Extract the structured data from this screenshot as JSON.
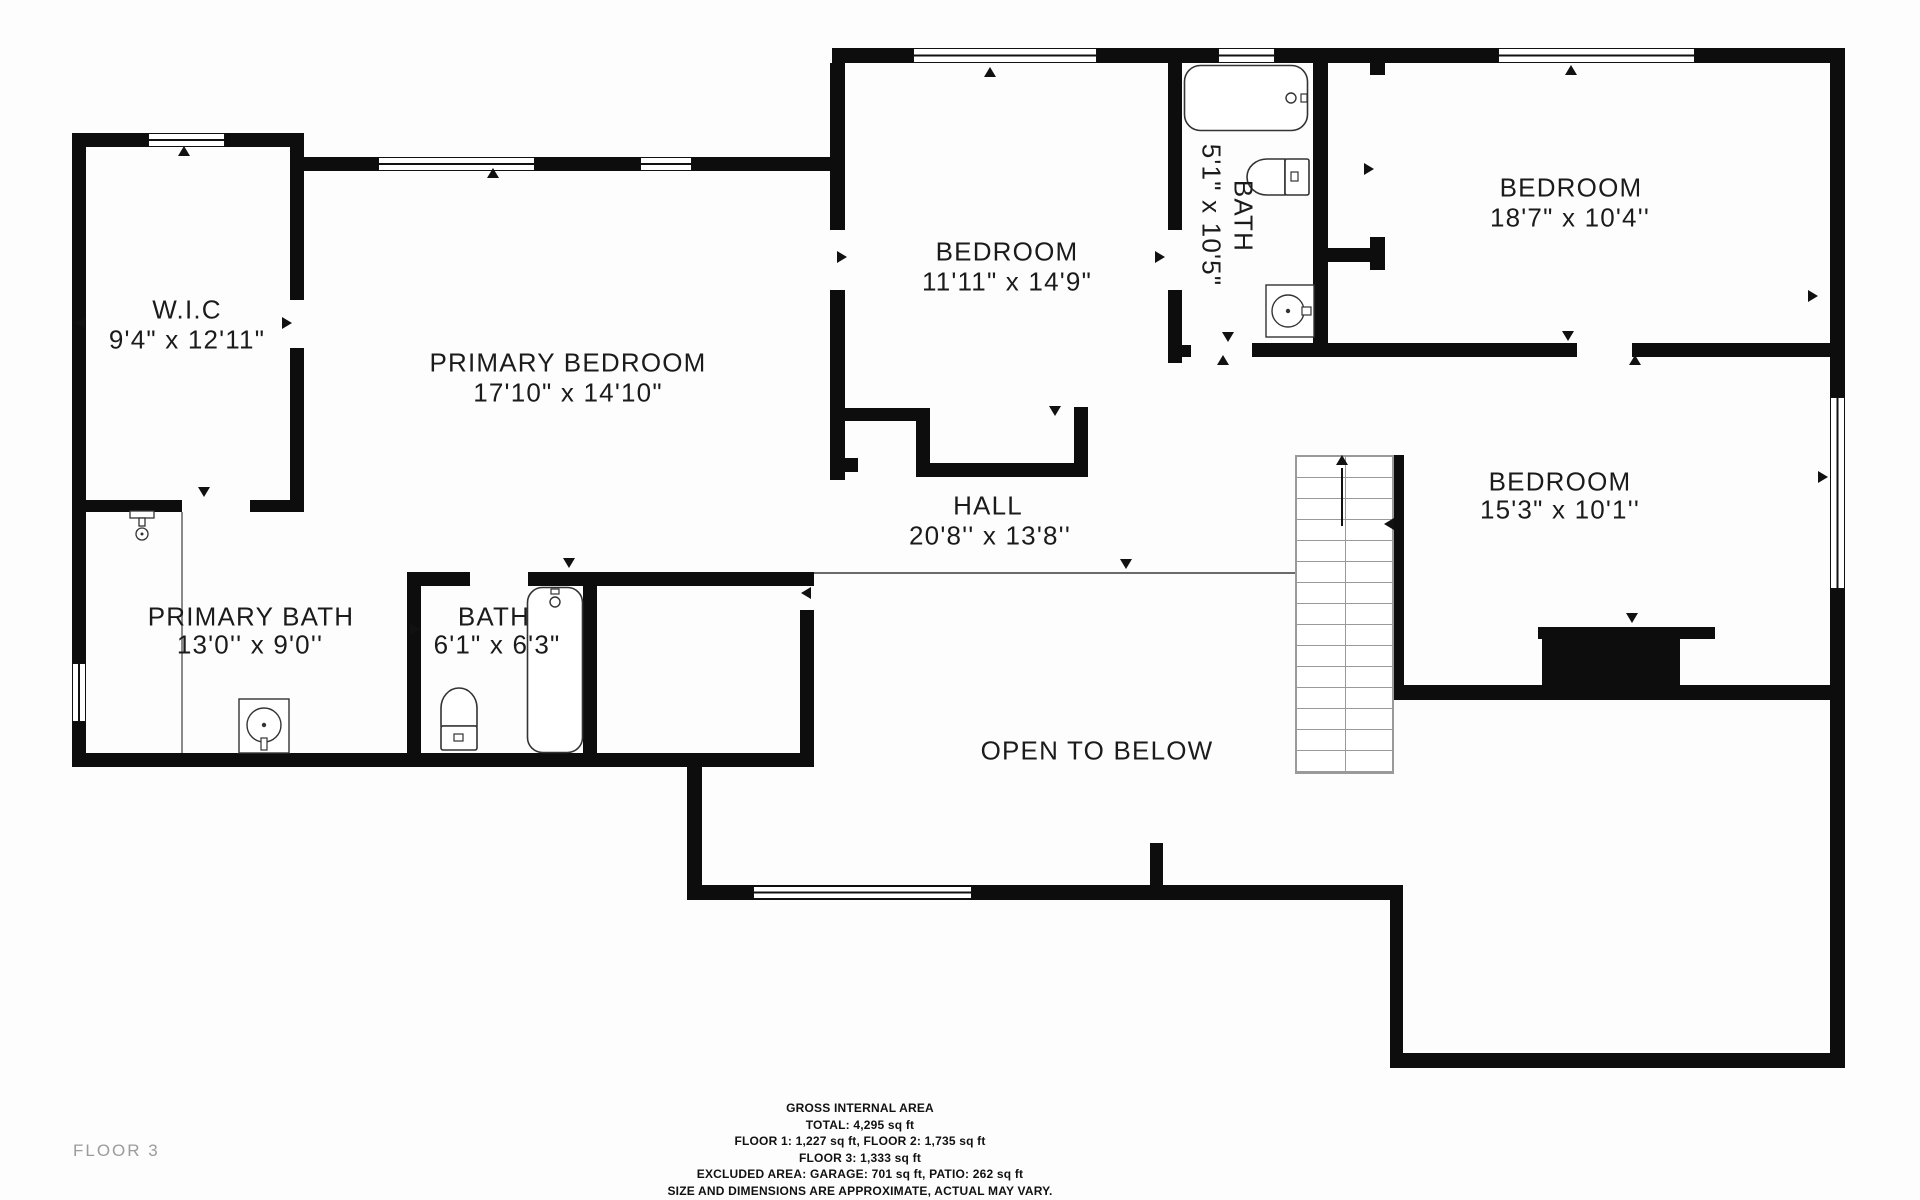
{
  "page": {
    "floor_label": "FLOOR 3",
    "background": "#fdfdfd"
  },
  "colors": {
    "wall": "#0d0d0d",
    "label": "#1b1b1b",
    "floor_label": "#9b9b9b",
    "stair_line": "#9a9a9a",
    "fixture_stroke": "#333333"
  },
  "rooms": [
    {
      "id": "wic",
      "name": "W.I.C",
      "dims": "9'4\" x 12'11\""
    },
    {
      "id": "primary-bedroom",
      "name": "PRIMARY BEDROOM",
      "dims": "17'10\" x 14'10\""
    },
    {
      "id": "bedroom-middle",
      "name": "BEDROOM",
      "dims": "11'11\" x 14'9\""
    },
    {
      "id": "bath-upper",
      "name": "BATH",
      "dims": "5'1\" x 10'5\""
    },
    {
      "id": "bedroom-top-right",
      "name": "BEDROOM",
      "dims": "18'7\" x 10'4''"
    },
    {
      "id": "hall",
      "name": "HALL",
      "dims": "20'8'' x 13'8''"
    },
    {
      "id": "bedroom-right",
      "name": "BEDROOM",
      "dims": "15'3\" x 10'1''"
    },
    {
      "id": "primary-bath",
      "name": "PRIMARY BATH",
      "dims": "13'0'' x 9'0''"
    },
    {
      "id": "bath-small",
      "name": "BATH",
      "dims": "6'1\" x 6'3\""
    },
    {
      "id": "open-to-below",
      "name": "OPEN TO BELOW",
      "dims": ""
    }
  ],
  "footer": {
    "lines": [
      "GROSS INTERNAL AREA",
      "TOTAL: 4,295 sq ft",
      "FLOOR 1: 1,227 sq ft, FLOOR 2: 1,735 sq ft",
      "FLOOR 3: 1,333 sq ft",
      "EXCLUDED AREA: GARAGE: 701 sq ft, PATIO: 262 sq ft",
      "SIZE AND DIMENSIONS ARE APPROXIMATE, ACTUAL MAY VARY."
    ]
  },
  "icons": {
    "bathtub-icon": "rounded-rect tub outline with faucet dot",
    "toilet-icon": "bowl ellipse with tank rect",
    "sink-icon": "square vanity with round basin",
    "shower-icon": "shower head with stem",
    "stairs-up-arrow-icon": "vertical shaft with up triangle",
    "door-marker-icon": "small solid triangle",
    "window-icon": "white inset with center mullion line"
  }
}
